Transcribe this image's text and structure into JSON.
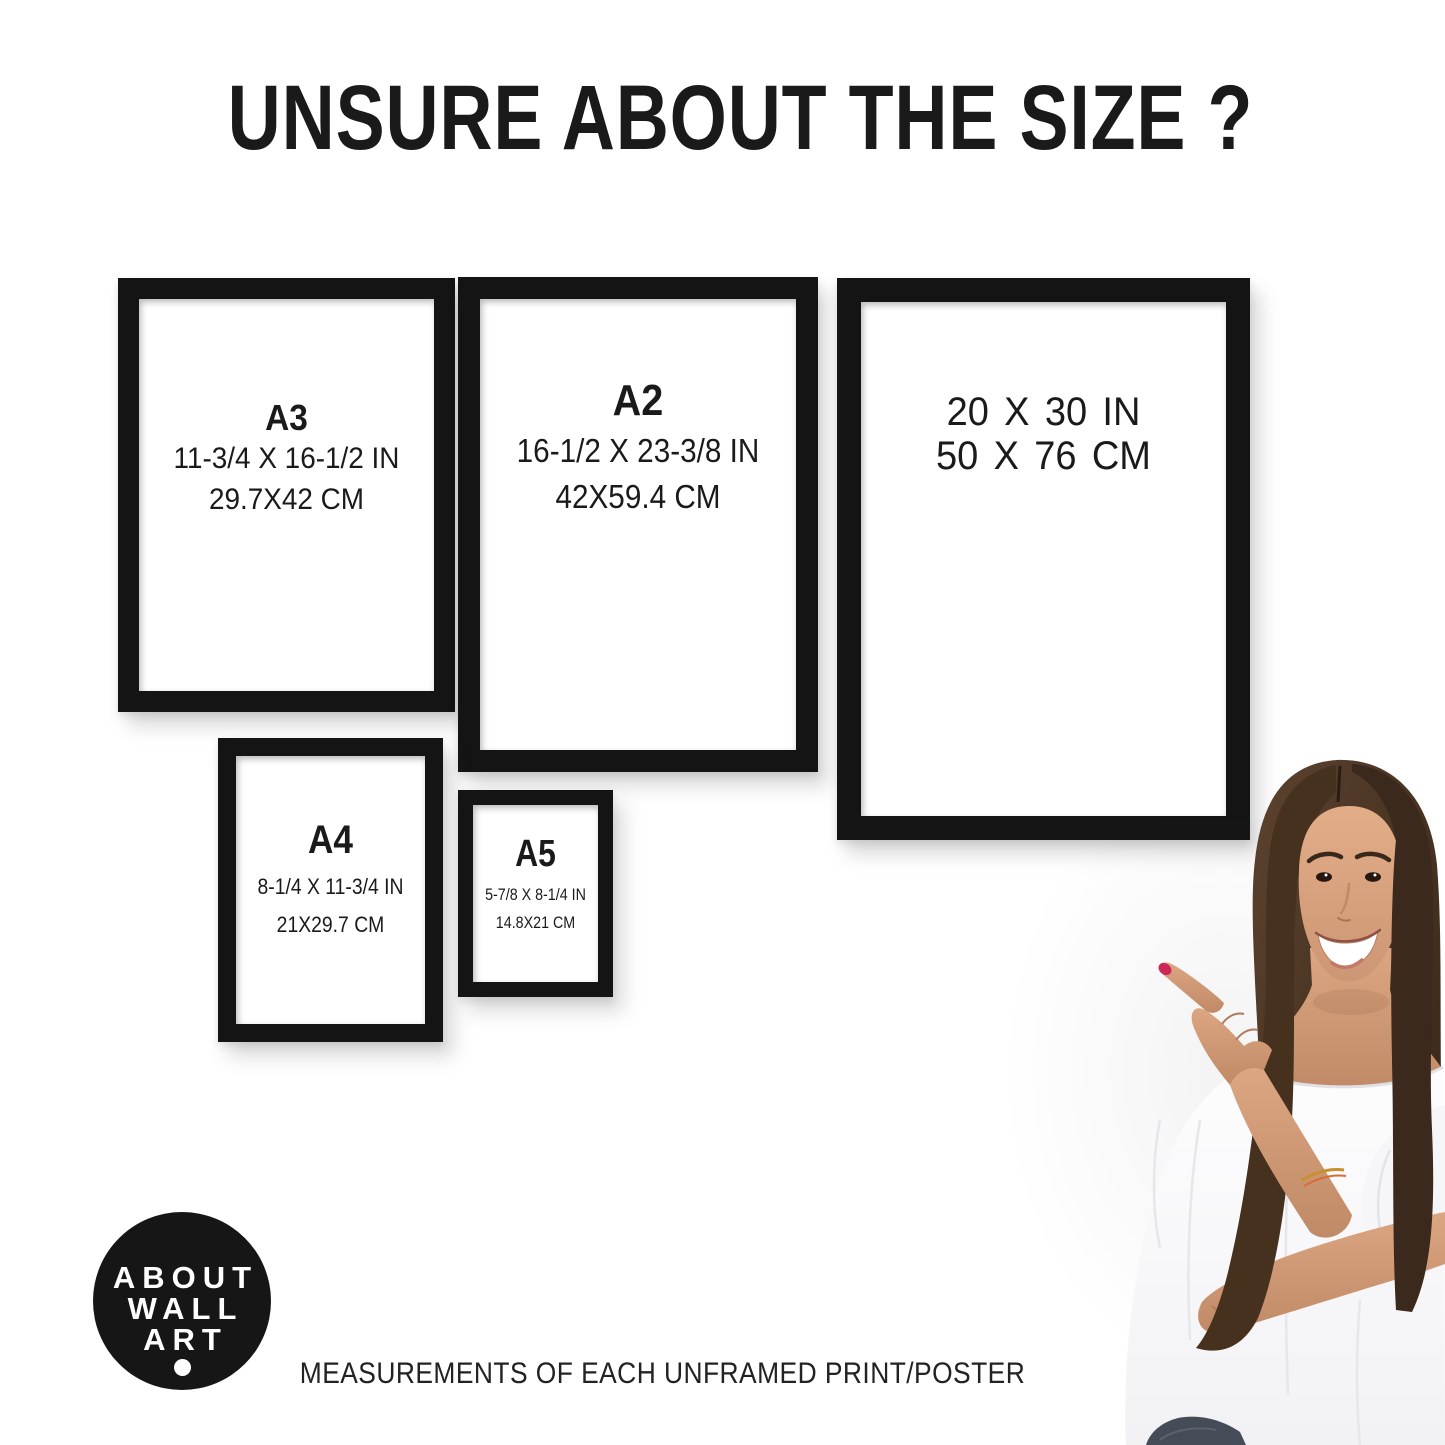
{
  "title": "UNSURE ABOUT THE SIZE ?",
  "frames": [
    {
      "name": "A3",
      "label": "A3",
      "inches": "11-3/4 X 16-1/2 IN",
      "cm": "29.7X42 CM"
    },
    {
      "name": "A2",
      "label": "A2",
      "inches": "16-1/2 X 23-3/8 IN",
      "cm": "42X59.4 CM"
    },
    {
      "name": "20x30",
      "inches": "20 X 30 IN",
      "cm": "50 X 76 CM"
    },
    {
      "name": "A4",
      "label": "A4",
      "inches": "8-1/4 X 11-3/4 IN",
      "cm": "21X29.7 CM"
    },
    {
      "name": "A5",
      "label": "A5",
      "inches": "5-7/8 X 8-1/4 IN",
      "cm": "14.8X21 CM"
    }
  ],
  "logo": {
    "line1": "ABOUT",
    "line2": "WALL",
    "line3": "ART"
  },
  "caption": "MEASUREMENTS OF EACH UNFRAMED PRINT/POSTER",
  "colors": {
    "background": "#ffffff",
    "frame_black": "#141414",
    "text_black": "#1a1a1a",
    "logo_background": "#161616",
    "logo_text": "#ffffff",
    "nail_polish": "#ce2757",
    "hair_brown": "#4a3526",
    "skin_tone": "#d19b79",
    "blouse_white": "#fafafb",
    "jeans_dark": "#454b57"
  }
}
